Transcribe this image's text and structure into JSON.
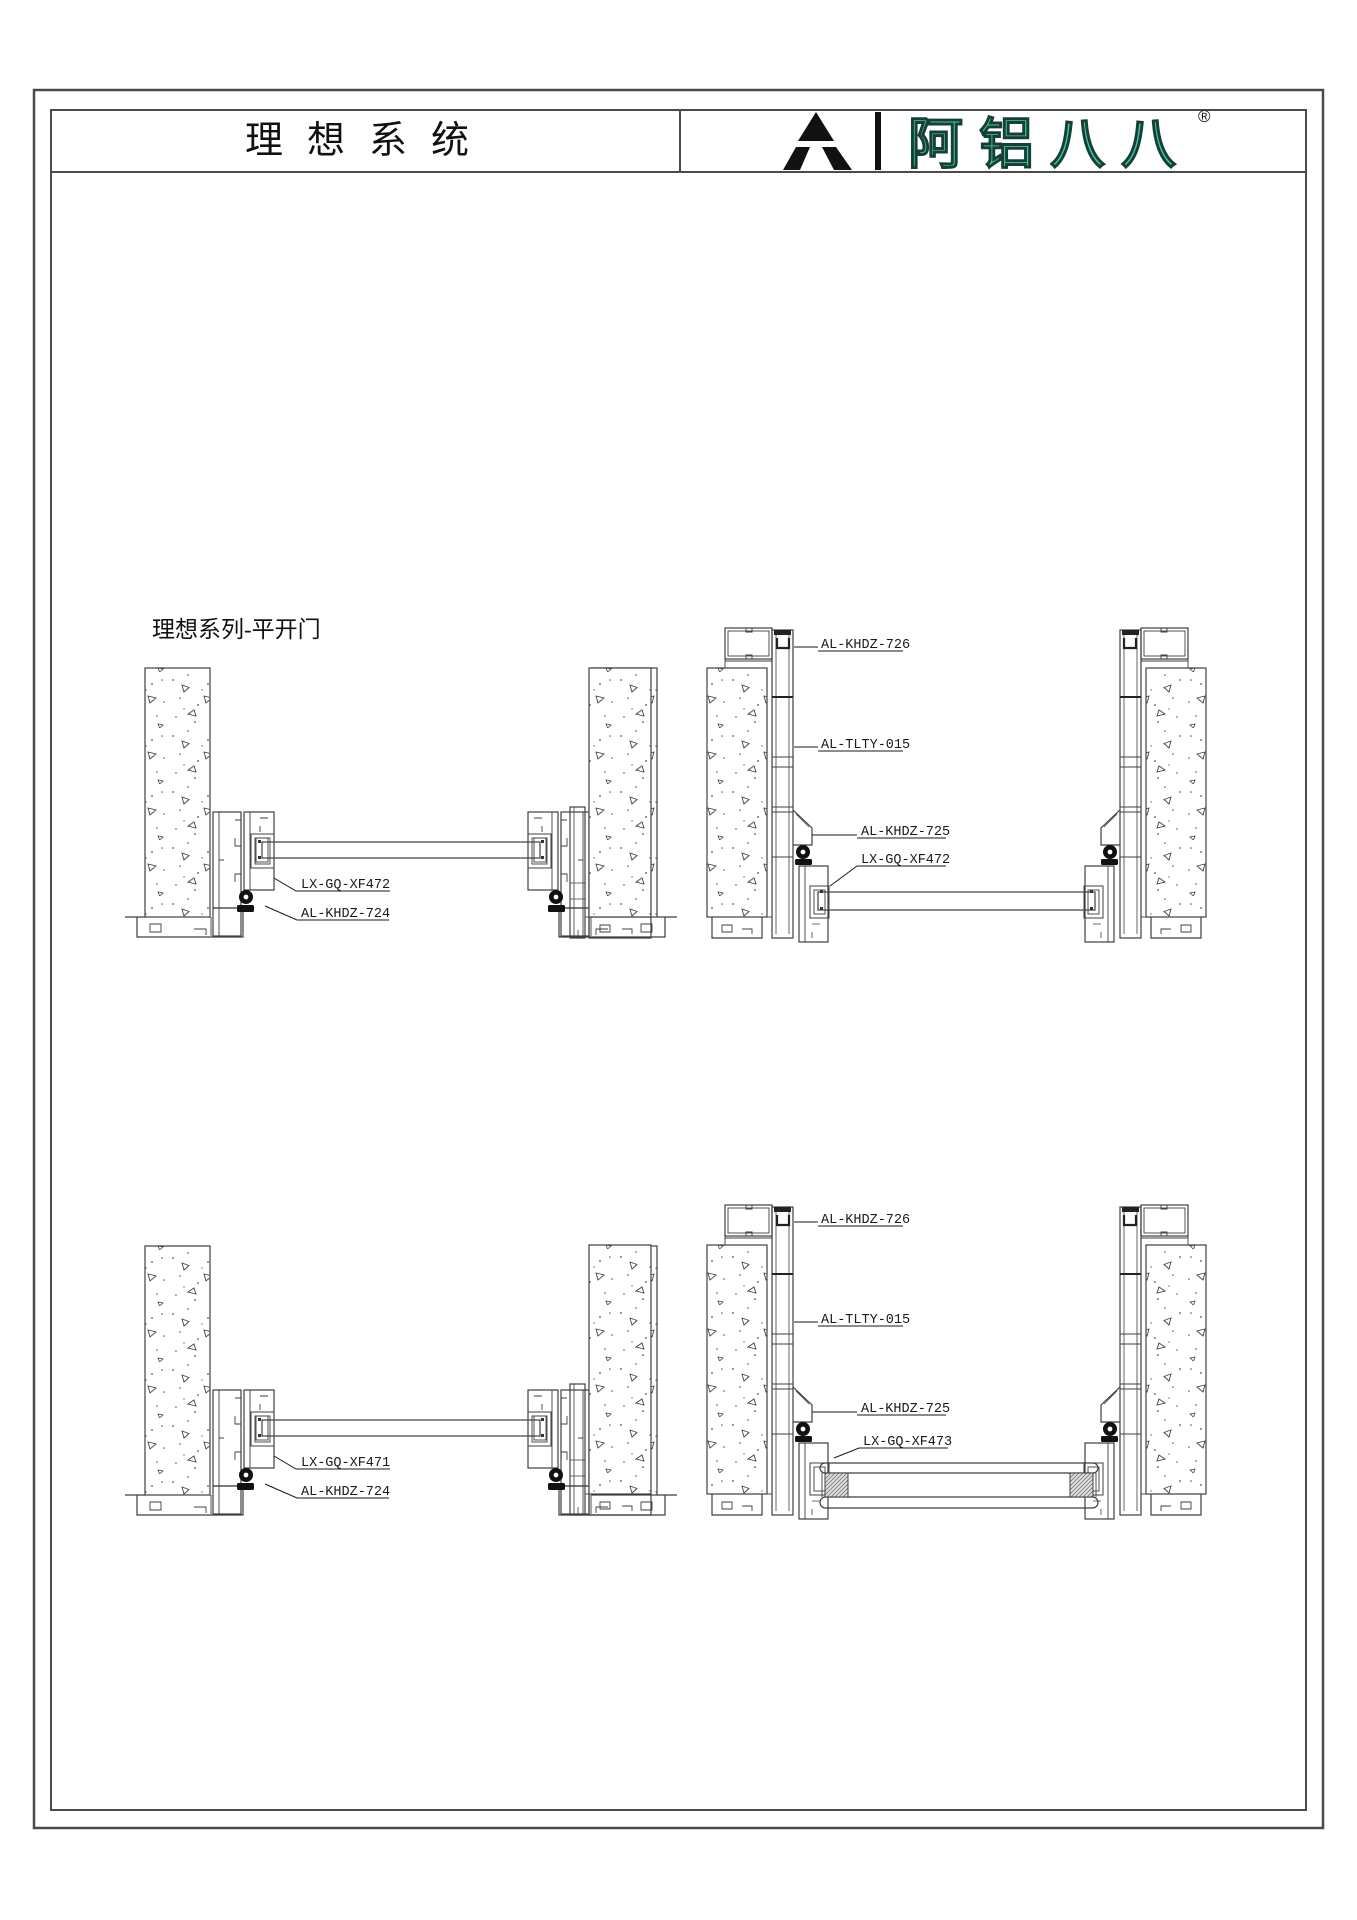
{
  "header": {
    "title": "理想系统",
    "logo": {
      "brand": "阿铝八八",
      "registered": "®"
    }
  },
  "section_label": "理想系列-平开门",
  "drawings": {
    "top_left": {
      "label_sash": "LX-GQ-XF472",
      "label_sill": "AL-KHDZ-724"
    },
    "top_right": {
      "label_head_tube": "AL-KHDZ-726",
      "label_mullion": "AL-TLTY-015",
      "label_adapter": "AL-KHDZ-725",
      "label_sash": "LX-GQ-XF472"
    },
    "bottom_left": {
      "label_sash": "LX-GQ-XF471",
      "label_sill": "AL-KHDZ-724"
    },
    "bottom_right": {
      "label_head_tube": "AL-KHDZ-726",
      "label_mullion": "AL-TLTY-015",
      "label_adapter": "AL-KHDZ-725",
      "label_sash": "LX-GQ-XF473"
    }
  },
  "colors": {
    "line": "#3f3f3f",
    "brand_teal": "#3CC9A6"
  }
}
